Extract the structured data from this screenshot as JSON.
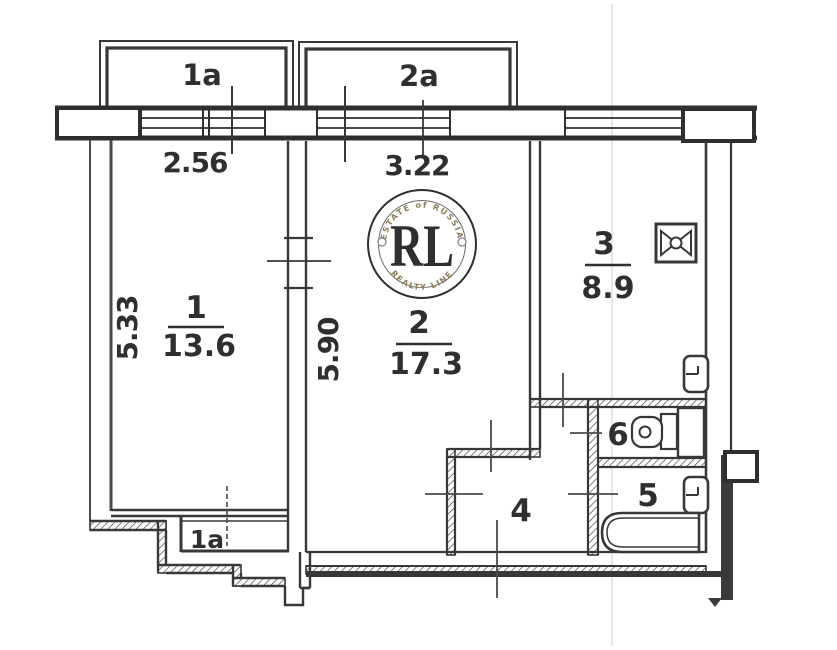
{
  "plan": {
    "rooms": [
      {
        "id": "room-1",
        "number": "1",
        "area": "13.6"
      },
      {
        "id": "room-2",
        "number": "2",
        "area": "17.3"
      },
      {
        "id": "room-3",
        "number": "3",
        "area": "8.9"
      },
      {
        "id": "room-4",
        "number": "4"
      },
      {
        "id": "room-5",
        "number": "5"
      },
      {
        "id": "room-6",
        "number": "6"
      }
    ],
    "balconies": [
      {
        "id": "balcony-1a",
        "label": "1a"
      },
      {
        "id": "balcony-2a",
        "label": "2a"
      }
    ],
    "closet": {
      "label": "1a"
    },
    "dimensions": {
      "room1_width_m": "2.56",
      "room2_width_m": "3.22",
      "room1_depth_m": "5.33",
      "room2_depth_m": "5.90"
    }
  },
  "watermark": {
    "monogram": "RL",
    "arc_top": "ESTATE of RUSSIA",
    "arc_bottom": "REALTY LINE",
    "gold_dark": "#a6803c",
    "gold_mid": "#c5a05a",
    "gold_light": "#ddc188",
    "ring_color": "#2e2e2e"
  },
  "canvas": {
    "background": "#ffffff",
    "line_color": "#383838"
  }
}
